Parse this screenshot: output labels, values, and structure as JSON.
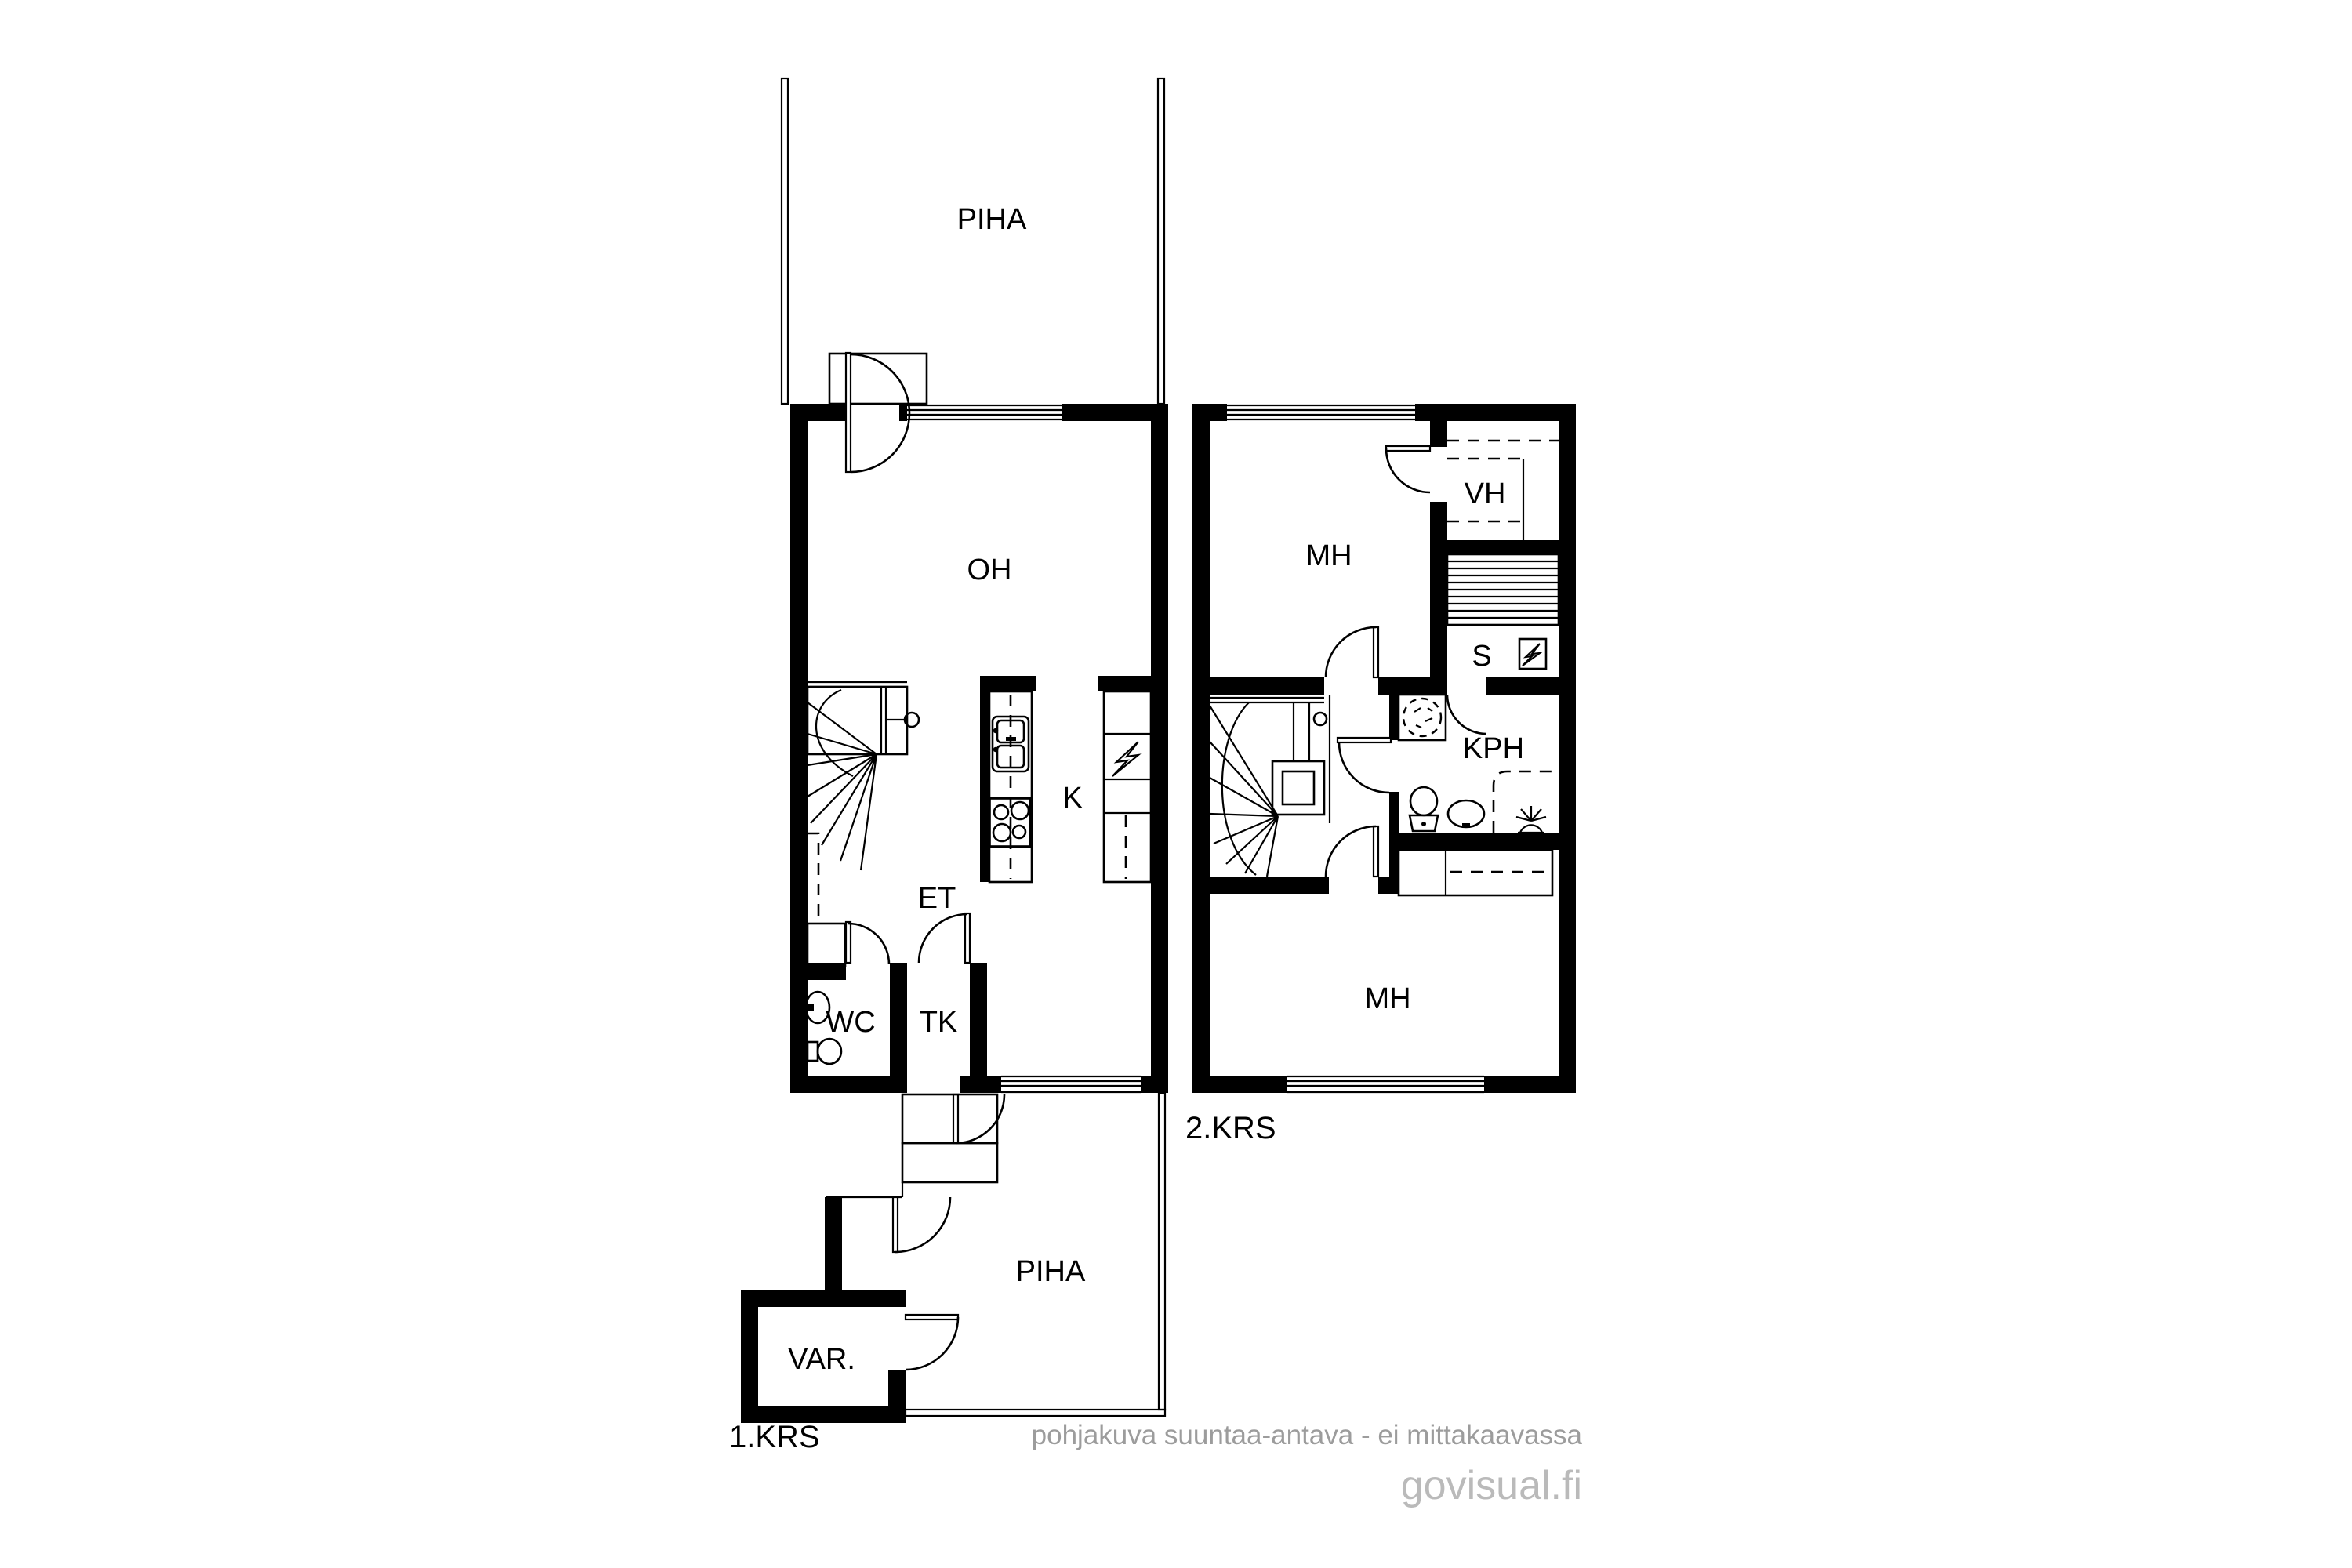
{
  "floors": {
    "first": {
      "floor_label": "1.KRS",
      "rooms": {
        "yard_top": "PIHA",
        "living_room": "OH",
        "kitchen": "K",
        "entry_hall": "ET",
        "wc": "WC",
        "vestibule": "TK",
        "yard_bottom": "PIHA",
        "storage": "VAR."
      }
    },
    "second": {
      "floor_label": "2.KRS",
      "rooms": {
        "bedroom_top": "MH",
        "walk_in_closet": "VH",
        "utility": "S",
        "bathroom": "KPH",
        "bedroom_bottom": "MH"
      }
    }
  },
  "watermark": {
    "disclaimer": "pohjakuva suuntaa-antava - ei mittakaavassa",
    "brand": "govisual.fi"
  },
  "colors": {
    "wall": "#000000",
    "line": "#000000",
    "background": "#ffffff",
    "watermark_disclaimer": "#9c9c9c",
    "watermark_brand": "#bababa"
  }
}
